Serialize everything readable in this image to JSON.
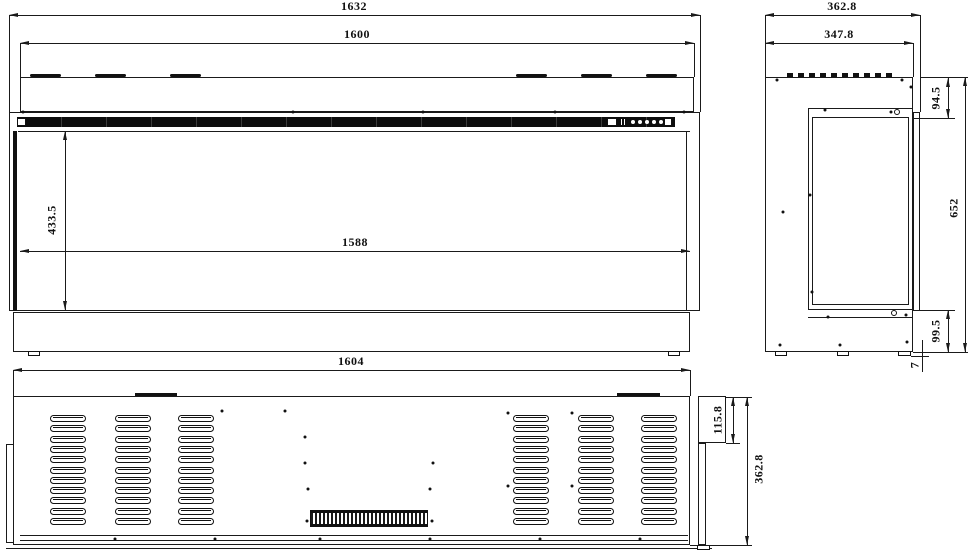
{
  "views": {
    "front": {
      "dims": {
        "overall_width": "1632",
        "top_width": "1600",
        "glass_height": "433.5",
        "opening_width": "1588"
      },
      "control_buttons": 5
    },
    "side": {
      "dims": {
        "overall_depth": "362.8",
        "body_depth": "347.8",
        "top_section_height": "94.5",
        "overall_height": "652",
        "base_height": "99.5",
        "foot_height": "7"
      }
    },
    "bottom": {
      "dims": {
        "body_width": "1604",
        "terminal_box_height": "115.8",
        "overall_depth": "362.8"
      },
      "vent_grid": {
        "columns": 6,
        "rows": 11
      }
    }
  },
  "colors": {
    "line": "#1a1a1a",
    "fill_black": "#111111",
    "background": "#ffffff"
  },
  "geometry": {
    "front_top_tabs_x": [
      30,
      95,
      170,
      516,
      581,
      646
    ],
    "vent_columns_x": [
      50,
      115,
      178,
      513,
      578,
      641
    ],
    "vent_rows": {
      "start_y": 415,
      "pitch": 10.3,
      "count": 11
    },
    "screws": [
      [
        23,
        112
      ],
      [
        293,
        112
      ],
      [
        423,
        112
      ],
      [
        555,
        112
      ],
      [
        684,
        112
      ],
      [
        777,
        80
      ],
      [
        902,
        80
      ],
      [
        911,
        87
      ],
      [
        825,
        110
      ],
      [
        891,
        112
      ],
      [
        810,
        195
      ],
      [
        783,
        212
      ],
      [
        812,
        292
      ],
      [
        828,
        317
      ],
      [
        906,
        315
      ],
      [
        780,
        345
      ],
      [
        840,
        345
      ],
      [
        907,
        342
      ],
      [
        222,
        411
      ],
      [
        285,
        411
      ],
      [
        305,
        437
      ],
      [
        305,
        463
      ],
      [
        433,
        463
      ],
      [
        308,
        489
      ],
      [
        430,
        489
      ],
      [
        508,
        413
      ],
      [
        572,
        413
      ],
      [
        508,
        486
      ],
      [
        572,
        486
      ],
      [
        307,
        521
      ],
      [
        432,
        521
      ],
      [
        115,
        539
      ],
      [
        215,
        539
      ],
      [
        320,
        539
      ],
      [
        430,
        539
      ],
      [
        540,
        539
      ],
      [
        640,
        539
      ]
    ]
  }
}
